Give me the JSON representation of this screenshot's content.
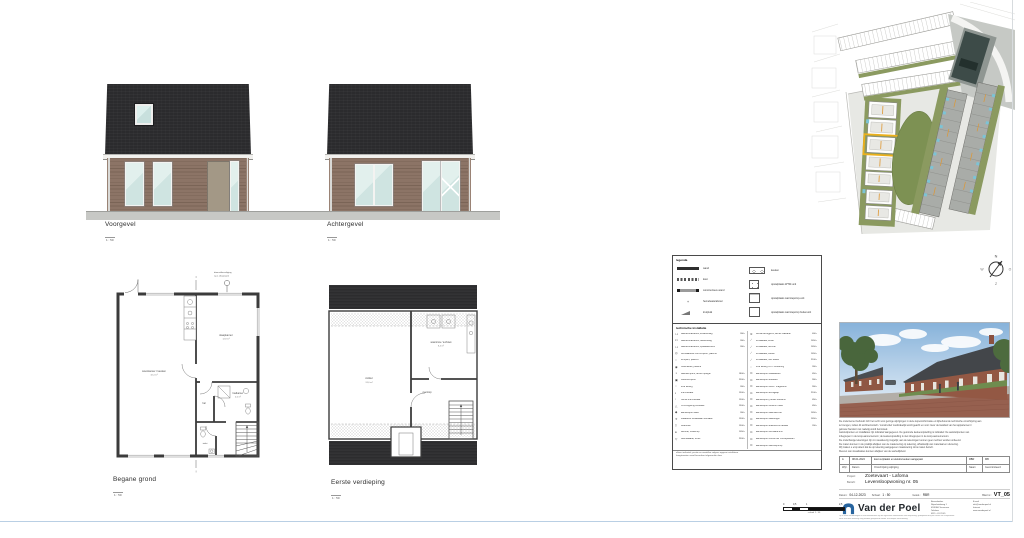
{
  "elevations": {
    "voorgevel": {
      "title": "Voorgevel",
      "scale": "1 : 50"
    },
    "achtergevel": {
      "title": "Achtergevel",
      "scale": "1 : 50"
    }
  },
  "plans": {
    "begane_grond": {
      "title": "Begane grond",
      "scale": "1 : 50",
      "note_line1": "doorvalbeveiliging",
      "note_line2": "t.p.v. draairaam",
      "rooms": {
        "woonkamer": "woonkamer / keuken",
        "woonkamer_opp": "32,4 m²",
        "slaapkamer": "slaapkamer",
        "slaapkamer_opp": "12,8 m²",
        "hal": "hal",
        "badkamer": "badkamer",
        "badkamer_opp": "4,6 m²",
        "toilet": "toilet"
      }
    },
    "eerste_verdieping": {
      "title": "Eerste verdieping",
      "scale": "1 : 50",
      "rooms": {
        "zolder": "zolder",
        "zolder_opp": "24,6 m²",
        "wasruimte": "wasruimte / techniek",
        "wasruimte_opp": "8,4 m²",
        "overloop": "overloop"
      }
    }
  },
  "compass": {
    "north": "N",
    "east": "O",
    "south": "Z",
    "west": "W"
  },
  "legend": {
    "title": "legenda",
    "general_left": [
      {
        "label": "wand",
        "sym": "sym-wand"
      },
      {
        "label": "kast",
        "sym": "sym-kast"
      },
      {
        "label": "constructieve wand",
        "sym": "sym-cwand"
      },
      {
        "label": "hemelwaterafvoer",
        "sym": "sym-hwa",
        "glyph": "+"
      },
      {
        "label": "kruipluik",
        "sym": "sym-kruip"
      }
    ],
    "general_right": [
      {
        "label": "keuken",
        "sym": "ico-keuken"
      },
      {
        "label": "opstelplaats WTW-unit",
        "sym": "ico-wtw"
      },
      {
        "label": "opstelplaats warmtepomp-unit",
        "sym": "ico-wp"
      },
      {
        "label": "opstelplaats warmtepomp buitenunit",
        "sym": "ico-buiten"
      }
    ],
    "install_title": "technische installatie",
    "install_left": [
      {
        "sym": "⊶",
        "label": "wandcontactdoos, enkelvoudig",
        "value": "300+"
      },
      {
        "sym": "⊷",
        "label": "wandcontactdoos, tweevoudig",
        "value": "300+"
      },
      {
        "sym": "⊶",
        "label": "wandcontactdoos, spatwaterdicht",
        "value": "300+"
      },
      {
        "sym": "◎",
        "label": "centraaldoos met lichtpunt, plafond",
        "value": ""
      },
      {
        "sym": "○",
        "label": "lichtpunt, plafond",
        "value": ""
      },
      {
        "sym": "◉",
        "label": "rookmelder, plafond",
        "value": ""
      },
      {
        "sym": "◑",
        "label": "wandlichtpunt, achter spiegel",
        "value": "1800+"
      },
      {
        "sym": "▣",
        "label": "buitenlichtpunt",
        "value": "2300+"
      },
      {
        "sym": "◌",
        "label": "loze leiding",
        "value": "300+"
      },
      {
        "sym": "▪",
        "label": "thermostaat",
        "value": "1500+"
      },
      {
        "sym": "▫",
        "label": "ruimte thermostaat",
        "value": "1500+"
      },
      {
        "sym": "△",
        "label": "CO2-regeling ventilatie",
        "value": "1500+"
      },
      {
        "sym": "◆",
        "label": "aansluitpunt data",
        "value": "300+"
      },
      {
        "sym": "✳",
        "label": "draadloze schakelaar ventilatie",
        "value": "1500+"
      },
      {
        "sym": "▯",
        "label": "videofoon",
        "value": "1500+"
      },
      {
        "sym": "●",
        "label": "deurbel, drukknop",
        "value": "1050+"
      },
      {
        "sym": "▽",
        "label": "belinstallatie, schel",
        "value": "2300+"
      }
    ],
    "install_right": [
      {
        "sym": "≋",
        "label": "ventiel afzuigpunt, achter wastafel",
        "value": "400+"
      },
      {
        "sym": "⟋",
        "label": "schakelaar, enkel",
        "value": "1050+"
      },
      {
        "sym": "⟋",
        "label": "schakelaar, dimmer",
        "value": "1050+"
      },
      {
        "sym": "⟋",
        "label": "schakelaar, wissel",
        "value": "1050+"
      },
      {
        "sym": "⟋",
        "label": "schakelaar, met wissel",
        "value": "2100+"
      },
      {
        "sym": "┈",
        "label": "loze leiding t.b.v. zonwering",
        "value": "300+"
      },
      {
        "sym": "⊙",
        "label": "aansluitpunt vaatwasser",
        "value": "450+"
      },
      {
        "sym": "⊙",
        "label": "aansluitpunt koelkast",
        "value": "900+"
      },
      {
        "sym": "⊙",
        "label": "aansluitpunt oven / magnetron",
        "value": "900+"
      },
      {
        "sym": "⊙",
        "label": "aansluitpunt afzuigkap",
        "value": "2100+"
      },
      {
        "sym": "⊙",
        "label": "aansluitpunt, perilex kookunit",
        "value": "450+"
      },
      {
        "sym": "⊙",
        "label": "aansluitpunt close-in boiler",
        "value": "450+"
      },
      {
        "sym": "⊙",
        "label": "aansluitpunt wasmachine",
        "value": "1050+"
      },
      {
        "sym": "⊙",
        "label": "aansluitpunt wasdroger",
        "value": "1050+"
      },
      {
        "sym": "⊙",
        "label": "aansluitpunt elektrische radiator",
        "value": "200+"
      },
      {
        "sym": "⊙",
        "label": "aansluitpunt ventilatie-unit",
        "value": ""
      },
      {
        "sym": "⊙",
        "label": "aansluitpunt omvormer zonnepanelen",
        "value": ""
      },
      {
        "sym": "⊙",
        "label": "aansluitpunt warmtepomp",
        "value": ""
      }
    ],
    "notes": [
      "alleen indicatief; positie en aantallen volgens opgave installateur",
      "hoogtematen vanaf bovenkant afgewerkte vloer"
    ]
  },
  "disclaimer": [
    "De ondernemer behoudt zich het recht voor geringe wijzigingen in deze kopersinformatie en bijbehorende technische omschrijving aan",
    "te brengen, indien dit architectonisch / constructief noodzakelijk wordt geacht en voor zover de kwaliteit van het appartement /",
    "gebouw hierdoor niet nadelig wordt beïnvloed.",
    "Aansluitpunten en installaties zijn indicatief aangegeven. De getoonde keukenopstelling is indicatief. De aansluitpunten van",
    "inbegrepen in de koop-aannemersom; de keukenopstelling is niet inbegrepen in de koop-aannemersom.",
    "De onderhavige tekeningen zijn zo nauwkeurig mogelijk; aan de tekeningen kunnen geen rechten worden ontleend.",
    "De maten kunnen in de praktijk afwijken van de maatvoering op tekening, afhankelijk van materiaal en uitvoering.",
    "Wij maken u erop attent dat de op tekening aangegeven maatvoering circa maten betreft.",
    "Kleuren van visualisaties kunnen afwijken van de werkelijkheid."
  ],
  "revision": {
    "row": {
      "wijz": "A",
      "datum": "08-01-2024",
      "omschrijving": "kast verplaatst en elektra keuken aangepast",
      "naam": "RBR",
      "gecontroleerd": "MB"
    },
    "header": {
      "wijz": "Wijz.",
      "datum": "Datum",
      "omschrijving": "Omschrijving wijziging",
      "naam": "Naam",
      "gecontroleerd": "Gecontroleerd"
    }
  },
  "titleblock": {
    "project_label": "Project:",
    "project": "Zoetevaart - Lafoma",
    "betreft_label": "Betreft:",
    "betreft": "Levensloopwoning nr. 05",
    "datum_label": "Datum:",
    "datum": "04-12-2023",
    "schaal_label": "Schaal:",
    "schaal": "1 : 50",
    "getekend_label": "Getek.:",
    "getekend": "RBR",
    "blad_label": "Blad nr.:",
    "blad": "VT_05"
  },
  "company": {
    "name": "Van der Poel",
    "contact_left": [
      "Bezoekadres",
      "Nijverheidsweg 1",
      "4538 AX Terneuzen",
      "Telefoon",
      "0115 - 61 23 45"
    ],
    "contact_right": [
      "E-mail",
      "info@vanderpoel.nl",
      "Internet",
      "www.vanderpoel.nl"
    ],
    "footer": [
      "Op al onze aanbiedingen en overeenkomsten zijn de algemene voorwaarden van toepassing, gedeponeerd bij de Kamer van Koophandel.",
      "Niets van deze tekening mag worden gekopieerd zonder schriftelijke toestemming."
    ]
  },
  "scalebar": {
    "t0": "0",
    "t05": "0,5",
    "t1": "1",
    "t25": "2,5",
    "caption": "schaal 1 : 50"
  }
}
